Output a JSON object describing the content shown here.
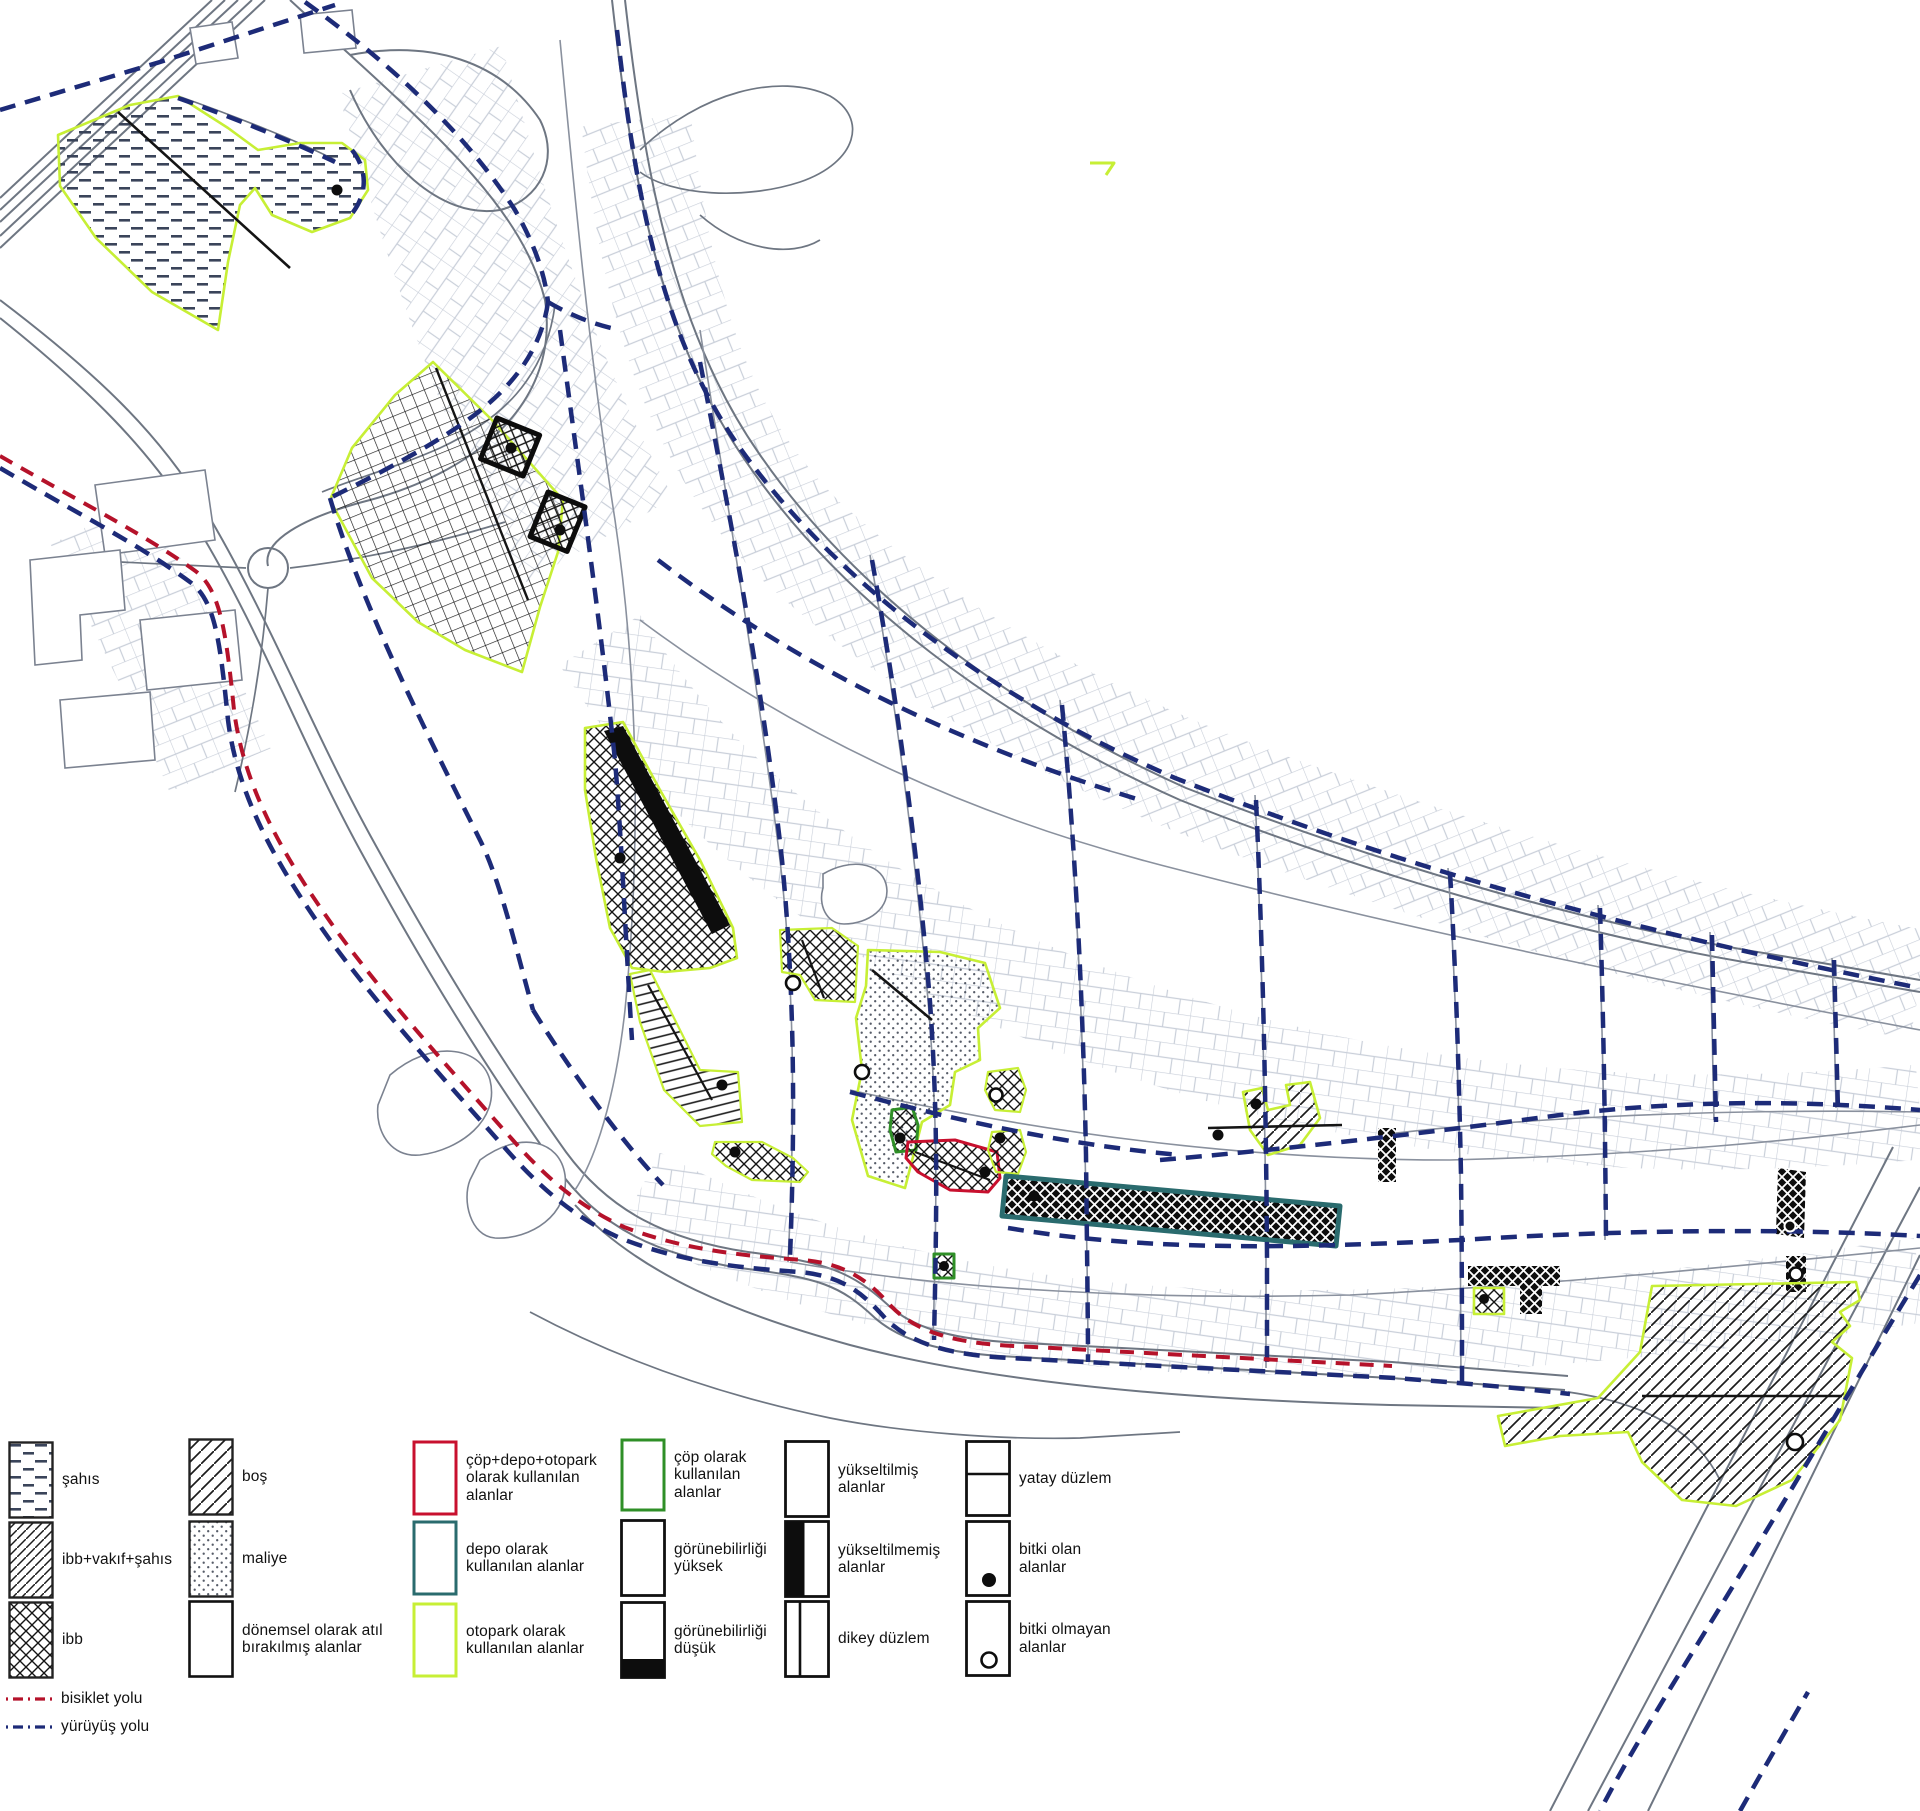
{
  "legend": {
    "items": [
      {
        "label": "şahıs",
        "swatch": "dash-pattern"
      },
      {
        "label": "ibb+vakıf+şahıs",
        "swatch": "diagonal-hatch-dense"
      },
      {
        "label": "ibb",
        "swatch": "cross-hatch"
      },
      {
        "label": "boş",
        "swatch": "diagonal-hatch"
      },
      {
        "label": "maliye",
        "swatch": "dot-pattern"
      },
      {
        "label": "dönemsel olarak atıl bırakılmış alanlar",
        "swatch": "empty-black-outline"
      },
      {
        "label": "çöp+depo+otopark olarak kullanılan alanlar",
        "swatch": "outline",
        "color": "#c8102e"
      },
      {
        "label": "depo olarak kullanılan alanlar",
        "swatch": "outline",
        "color": "#2a6b6e"
      },
      {
        "label": "otopark olarak kullanılan alanlar",
        "swatch": "outline",
        "color": "#c7ef35"
      },
      {
        "label": "çöp olarak kullanılan alanlar",
        "swatch": "outline",
        "color": "#2f8f27"
      },
      {
        "label": "görünebilirliği yüksek",
        "swatch": "empty-black-outline"
      },
      {
        "label": "görünebilirliği düşük",
        "swatch": "bottom-black"
      },
      {
        "label": "yükseltilmiş alanlar",
        "swatch": "empty-black-outline"
      },
      {
        "label": "yükseltilmemiş alanlar",
        "swatch": "left-black"
      },
      {
        "label": "dikey düzlem",
        "swatch": "vertical-divider"
      },
      {
        "label": "yatay düzlem",
        "swatch": "horizontal-divider"
      },
      {
        "label": "bitki olan alanlar",
        "swatch": "filled-dot"
      },
      {
        "label": "bitki olmayan alanlar",
        "swatch": "open-dot"
      },
      {
        "label": "bisiklet yolu",
        "swatch": "dashed-line",
        "color": "#b5122a"
      },
      {
        "label": "yürüyüş yolu",
        "swatch": "dashed-line",
        "color": "#1d2b78"
      }
    ]
  },
  "colors": {
    "parking_outline_lime": "#c7ef35",
    "garbage_depot_parking_outline_red": "#c8102e",
    "depot_outline_teal": "#2a6b6e",
    "garbage_outline_green": "#2f8f27",
    "walking_path_navy": "#1d2b78",
    "bike_path_red": "#b5122a",
    "road_gray": "#6e7682",
    "parcel_gray": "#c9cfd9",
    "ink_black": "#141414"
  },
  "map": {
    "patterned_areas": [
      {
        "name": "sahis-area-northwest",
        "classes": [
          "şahıs",
          "otopark olarak kullanılan alanlar",
          "bitki olan alanlar"
        ]
      },
      {
        "name": "ibb-grid-area-center-north",
        "classes": [
          "ibb",
          "otopark olarak kullanılan alanlar",
          "bitki olan alanlar"
        ]
      },
      {
        "name": "low-visibility-black-strip-center",
        "classes": [
          "görünebilirliği düşük",
          "ibb",
          "otopark olarak kullanılan alanlar"
        ]
      },
      {
        "name": "maliye-dotted-area-center",
        "classes": [
          "maliye",
          "otopark olarak kullanılan alanlar",
          "bitki olmayan alanlar"
        ]
      },
      {
        "name": "red-outlined-mixed-use-area",
        "classes": [
          "çöp+depo+otopark olarak kullanılan alanlar",
          "ibb",
          "bitki olan alanlar"
        ]
      },
      {
        "name": "teal-depot-strip",
        "classes": [
          "depo olarak kullanılan alanlar",
          "görünebilirliği düşük",
          "bitki olan alanlar"
        ]
      },
      {
        "name": "green-outlined-garbage-patches",
        "classes": [
          "çöp olarak kullanılan alanlar",
          "bitki olan alanlar"
        ]
      },
      {
        "name": "bos-hatch-area-southeast",
        "classes": [
          "boş",
          "otopark olarak kullanılan alanlar",
          "bitki olmayan alanlar"
        ]
      },
      {
        "name": "black-diamond-patches-east",
        "classes": [
          "görünebilirliği düşük",
          "dikey düzlem"
        ]
      }
    ]
  }
}
